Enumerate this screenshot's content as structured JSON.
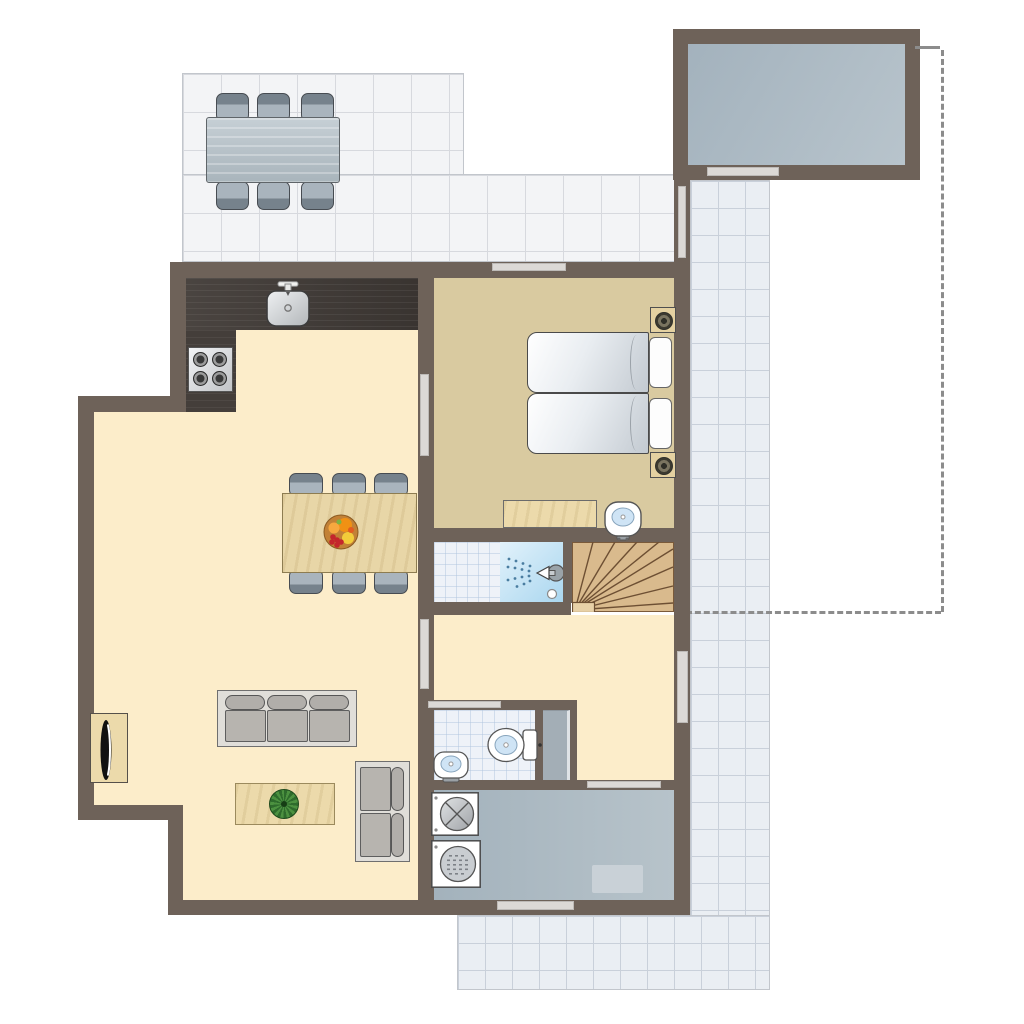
{
  "scene": {
    "type": "floor-plan",
    "label": "holiday home ground floor plan, top-down view",
    "canvas_px": {
      "width": 1024,
      "height": 1024
    },
    "text_labels_visible": "none"
  },
  "palette": {
    "wall": "#6e6259",
    "living_floor": "#fcedca",
    "bedroom_floor": "#d9caa0",
    "terrace_tile": "#f3f4f6",
    "path_tile": "#eaeef3",
    "bath_tile": "#eef2f8",
    "shower_blue": "#a9d6ef",
    "shed_floor": "#a9b8c3",
    "utility_floor": "#aab8c2",
    "kitchen_counter": "#403a36",
    "wood_furniture": "#ecdaab",
    "stairs_wood": "#d9ba8d",
    "window_door_bar": "#dcd9d6",
    "boundary_dash": "#8c8c8c"
  },
  "outdoor": {
    "terrace_top_left": {
      "surface": "large tiles",
      "furniture": [
        "outdoor-dining-table",
        "6 outdoor chairs (3 top, 3 bottom)"
      ]
    },
    "shed_top_right": {
      "floor": "blue-gray",
      "window_in_bottom_wall": true
    },
    "garden_gate_between_terrace_and_path": true,
    "tiled_path_right_side": true,
    "tiled_terrace_bottom": true,
    "plot_boundary": "dashed line from shed corner down right side, turning left to house wall"
  },
  "rooms": [
    {
      "name": "kitchen-living-room",
      "floor": "cream",
      "furniture": [
        "L-shaped dark counter",
        "sink with faucet",
        "stove with 4 burners",
        "dining table with fruit bowl",
        "6 dining chairs",
        "3-seat sofa",
        "2-seat sofa",
        "coffee table with plant",
        "tv cabinet with tv"
      ],
      "doors": [
        "to bedroom",
        "to hall"
      ]
    },
    {
      "name": "bedroom",
      "floor": "tan",
      "furniture": [
        "2 single beds with pillows",
        "2 nightstands with lamps",
        "dresser",
        "washbasin"
      ],
      "window_top_wall": true
    },
    {
      "name": "shower-room",
      "features": [
        "tiled floor",
        "shower stall with spray head and drain"
      ]
    },
    {
      "name": "staircase",
      "type": "winder stairs with landing"
    },
    {
      "name": "hall",
      "doors": [
        "front entrance on right wall",
        "to living room",
        "to toilet",
        "to utility room"
      ]
    },
    {
      "name": "toilet-room",
      "features": [
        "tiled floor",
        "toilet",
        "small washbasin",
        "gray door panel"
      ]
    },
    {
      "name": "utility-room",
      "floor": "gray",
      "furniture": [
        "washing-machine",
        "dryer",
        "doormat"
      ],
      "window_bottom_wall": true
    }
  ],
  "counts": {
    "outdoor_chairs": 6,
    "indoor_dining_chairs": 6,
    "beds": 2,
    "sofa_seats_total": 5,
    "stoves_burners": 4
  }
}
